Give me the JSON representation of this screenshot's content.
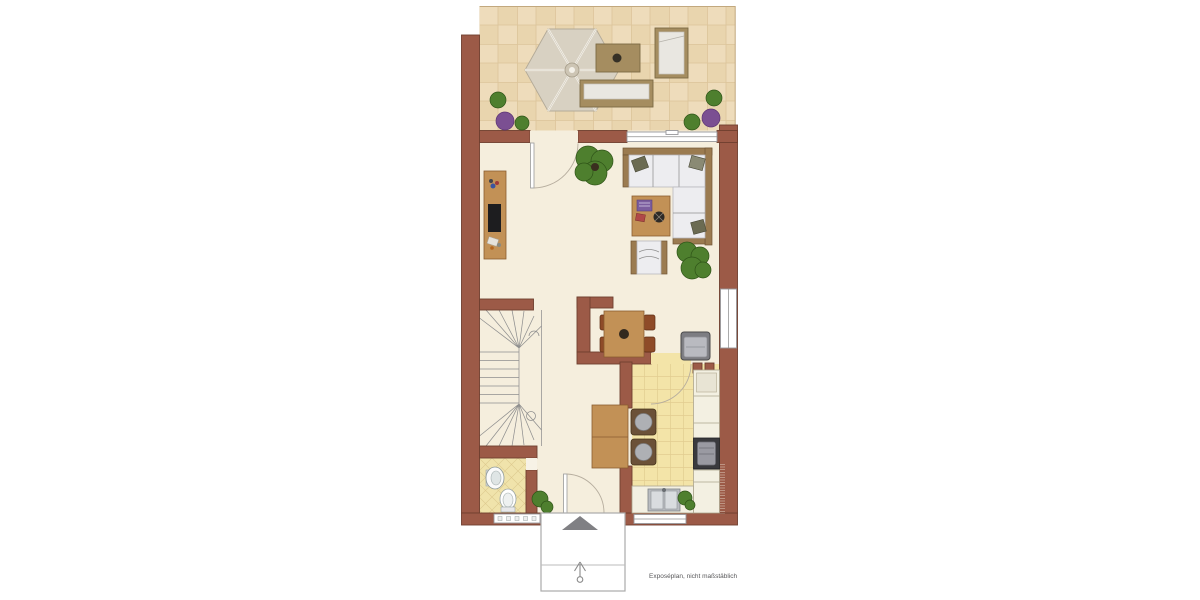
{
  "document": {
    "caption": "Exposéplan, nicht maßstäblich"
  },
  "plan": {
    "type": "residential-floor-plan",
    "rooms": [
      "terrace",
      "living-room",
      "dining-area",
      "kitchen",
      "hall",
      "bathroom-wc",
      "staircase",
      "entrance-porch"
    ],
    "furniture_icons": [
      "parasol-icon",
      "terrace-table-icon",
      "garden-bench-icon",
      "sun-lounger-icon",
      "plant-icon",
      "tv-sideboard-icon",
      "corner-sofa-icon",
      "coffee-table-icon",
      "armchair-icon",
      "dining-table-icon",
      "dining-chair-icon",
      "reading-chair-icon",
      "breakfast-table-icon",
      "kitchen-chair-icon",
      "kitchen-counter-icon",
      "stove-icon",
      "kitchen-sink-icon",
      "washbasin-icon",
      "toilet-icon",
      "radiator-icon",
      "entrance-arrow-icon",
      "door-swing-icon",
      "window-icon",
      "stairs-icon"
    ],
    "colors": {
      "wall": "#9c5a47",
      "wall-dark": "#6f3f2f",
      "floor-living": "#f5eedd",
      "terrace-a": "#eedcbb",
      "terrace-b": "#e9d5ae",
      "terrace-line": "#dcc49a",
      "kitchen-tile": "#f3e4a8",
      "kitchen-line": "#e2cd90",
      "bath-tile": "#f0e3ab",
      "bath-line": "#ddc98e",
      "wood": "#c29156",
      "wood-dark": "#8a5c30",
      "chair-brown": "#8e4b28",
      "cushion": "#ededf0",
      "cushion-line": "#b9b9bf",
      "sofa-frame": "#9b7b50",
      "plant-green": "#4e7f2e",
      "plant-green-dark": "#2f5418",
      "plant-purple": "#7b4f92",
      "gray-line": "#8f8f8f",
      "appliance": "#3a3a3e",
      "caption-color": "#58585a"
    }
  }
}
